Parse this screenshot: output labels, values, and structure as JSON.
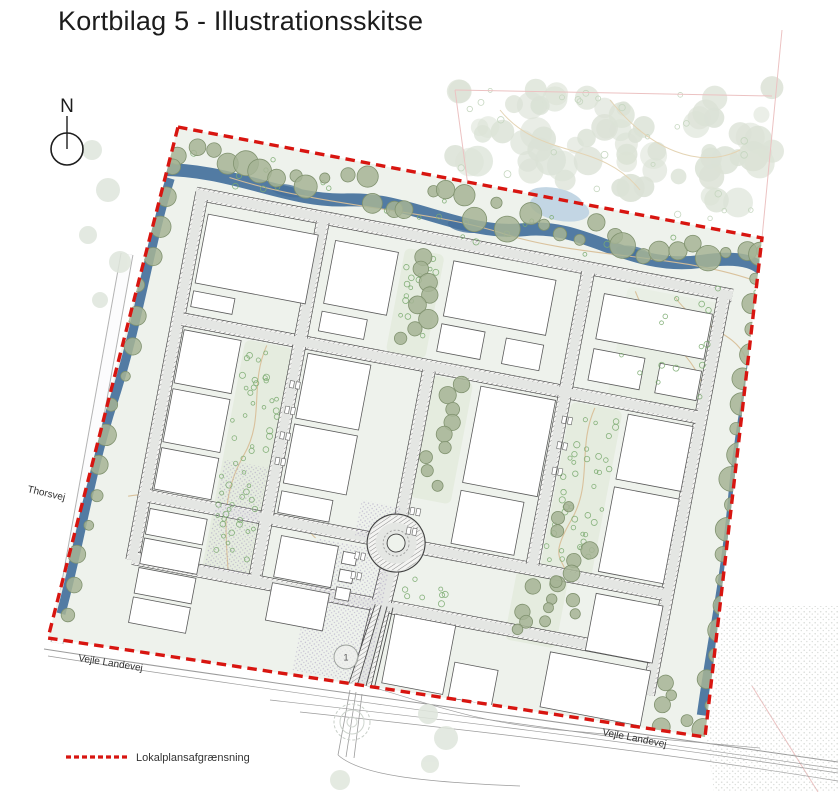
{
  "page": {
    "title": "Kortbilag 5 - Illustrationsskitse"
  },
  "compass": {
    "label": "N"
  },
  "map": {
    "street_labels": {
      "thorsvej": "Thorsvej",
      "vejle_landevej_west": "Vejle Landevej",
      "vejle_landevej_east": "Vejle Landevej"
    },
    "markers": {
      "roundabout_marker": "1"
    },
    "colors": {
      "boundary_red": "#d81510",
      "tree_olive": "#a6b495",
      "tree_olive_stroke": "#80926f",
      "tree_pale": "#dbe2d6",
      "stream_blue": "#527ba3",
      "stream_blue_light": "#c3d6e4",
      "road_fill": "#e4e6e3",
      "road_casing": "#3f3f3f",
      "site_background": "#eef2ec",
      "green_corridor": "#e5ecdf",
      "green_corridor_alt": "#e9efe5",
      "building_fill": "#ffffff",
      "building_stroke": "#5a5a5a",
      "path_tan": "#d8bf98",
      "shrub_green": "#7bab70",
      "stipple_purple": "#9d8fb8",
      "faint_pink": "#ecc2c2",
      "outside_gray": "#9b9b9b"
    }
  },
  "legend": {
    "items": [
      {
        "symbol": "red-dashed-line",
        "label": "Lokalplansafgrænsning"
      }
    ]
  }
}
